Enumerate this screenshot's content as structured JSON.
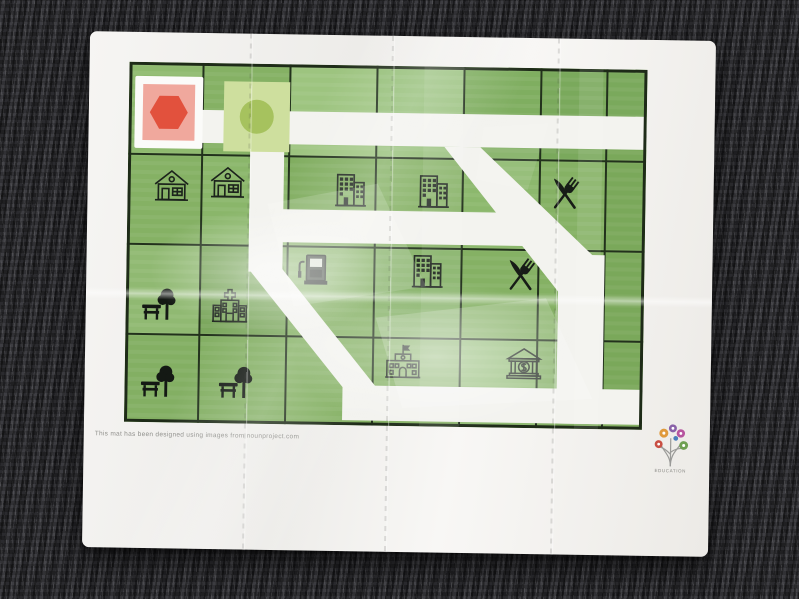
{
  "mat": {
    "caption": "This mat has been designed using images from nounproject.com",
    "logo_caption": "EDUCATION",
    "colors": {
      "mat_white": "#f4f3f1",
      "road": "#f3f3ef",
      "grass": "#85b164",
      "grid_line": "#22311c",
      "stop_tile_bg": "#f0a89d",
      "stop_sign": "#e2513d",
      "go_tile_bg": "#cedf9e",
      "go_sign": "#a6c25e",
      "icon_ink": "#1c231c"
    },
    "tiles": [
      {
        "id": "stop",
        "shape": "hexagon"
      },
      {
        "id": "go",
        "shape": "circle"
      }
    ],
    "icons": [
      {
        "type": "house",
        "x": 22,
        "y": 102
      },
      {
        "type": "house",
        "x": 78,
        "y": 98
      },
      {
        "type": "office",
        "x": 200,
        "y": 103
      },
      {
        "type": "office",
        "x": 283,
        "y": 103
      },
      {
        "type": "restaurant",
        "x": 415,
        "y": 104
      },
      {
        "type": "pump",
        "x": 167,
        "y": 183
      },
      {
        "type": "office",
        "x": 278,
        "y": 183
      },
      {
        "type": "restaurant",
        "x": 372,
        "y": 186
      },
      {
        "type": "park",
        "x": 12,
        "y": 220
      },
      {
        "type": "hospital",
        "x": 82,
        "y": 223
      },
      {
        "type": "park",
        "x": 12,
        "y": 297
      },
      {
        "type": "park",
        "x": 90,
        "y": 297
      },
      {
        "type": "school",
        "x": 256,
        "y": 276
      },
      {
        "type": "bank",
        "x": 377,
        "y": 276
      }
    ]
  }
}
